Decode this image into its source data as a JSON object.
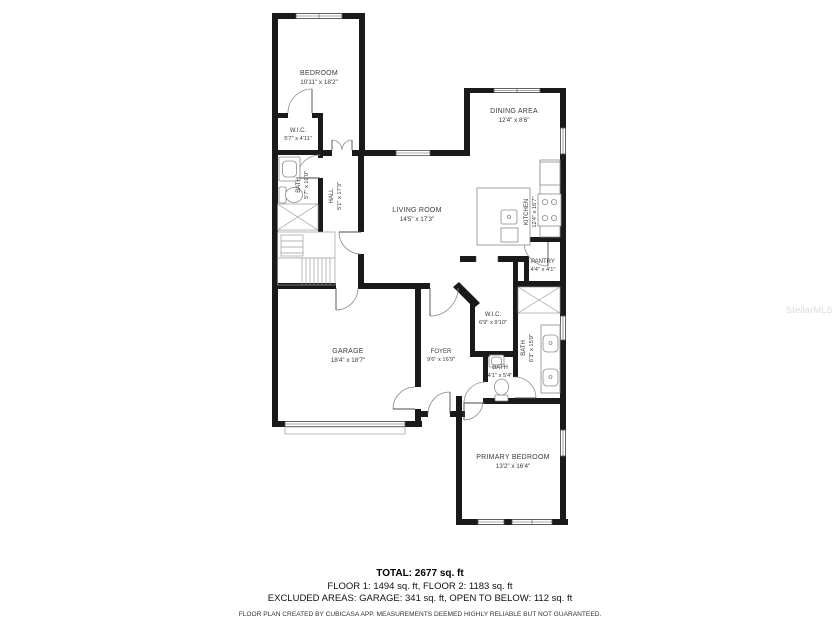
{
  "colors": {
    "wall": "#1a1a1a",
    "fixture_line": "#8a8a8a",
    "label_text": "#3a3a3a",
    "footer_text": "#000000",
    "watermark": "#dadada",
    "background": "#ffffff"
  },
  "plan": {
    "rooms": {
      "bedroom2": {
        "name": "BEDROOM",
        "dims": "10'11\" x 18'2\""
      },
      "wic2": {
        "name": "W.I.C.",
        "dims": "5'7\" x 4'11\""
      },
      "bath2": {
        "name": "BATH",
        "dims": "5'7\" x 10'0\""
      },
      "hall": {
        "name": "HALL",
        "dims": "5'1\" x 17'3\""
      },
      "dining": {
        "name": "DINING AREA",
        "dims": "12'4\" x 8'6\""
      },
      "living": {
        "name": "LIVING ROOM",
        "dims": "14'5\" x 17'3\""
      },
      "kitchen": {
        "name": "KITCHEN",
        "dims": "12'4\" x 16'7\""
      },
      "pantry": {
        "name": "PANTRY",
        "dims": "4'4\" x 4'1\""
      },
      "wic1": {
        "name": "W.I.C.",
        "dims": "6'9\" x 9'10\""
      },
      "foyer": {
        "name": "FOYER",
        "dims": "9'6\" x 16'9\""
      },
      "garage": {
        "name": "GARAGE",
        "dims": "18'4\" x 18'7\""
      },
      "bath1": {
        "name": "BATH",
        "dims": "6'3\" x 15'9\""
      },
      "bath_half": {
        "name": "BATH",
        "dims": "4'1\" x 5'4\""
      },
      "primary": {
        "name": "PRIMARY BEDROOM",
        "dims": "13'2\" x 16'4\""
      }
    }
  },
  "footer": {
    "total": "TOTAL: 2677 sq. ft",
    "floors": "FLOOR 1: 1494 sq. ft, FLOOR 2: 1183 sq. ft",
    "excluded": "EXCLUDED AREAS: GARAGE: 341 sq. ft, OPEN TO BELOW: 112 sq. ft",
    "disclaimer": "FLOOR PLAN CREATED BY CUBICASA APP. MEASUREMENTS DEEMED HIGHLY RELIABLE BUT NOT GUARANTEED."
  },
  "watermark": "StellarMLS"
}
